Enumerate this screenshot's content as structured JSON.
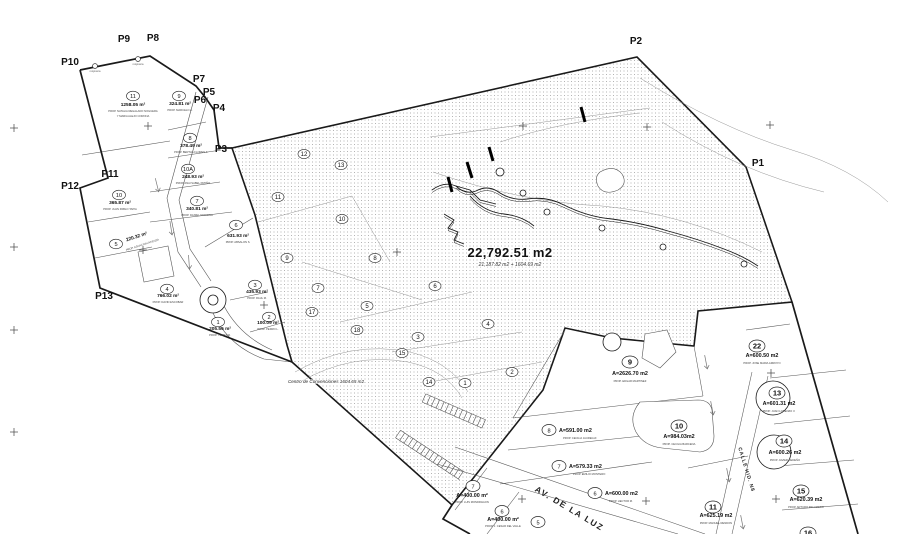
{
  "title_area": {
    "main": "22,792.51 m2",
    "sub": "21,187.82 m2 + 1604.69 m2"
  },
  "centro_label": "Centro de Convenciones 1604.65 m2",
  "boundary_points": [
    {
      "label": "P1",
      "x": 758,
      "y": 166
    },
    {
      "label": "P2",
      "x": 636,
      "y": 44
    },
    {
      "label": "P3",
      "x": 221,
      "y": 152
    },
    {
      "label": "P4",
      "x": 219,
      "y": 111
    },
    {
      "label": "P5",
      "x": 209,
      "y": 95
    },
    {
      "label": "P6",
      "x": 200,
      "y": 103
    },
    {
      "label": "P7",
      "x": 199,
      "y": 82
    },
    {
      "label": "P8",
      "x": 153,
      "y": 41
    },
    {
      "label": "P9",
      "x": 124,
      "y": 42
    },
    {
      "label": "P10",
      "x": 70,
      "y": 65
    },
    {
      "label": "P11",
      "x": 110,
      "y": 177
    },
    {
      "label": "P12",
      "x": 70,
      "y": 189
    },
    {
      "label": "P13",
      "x": 104,
      "y": 299
    }
  ],
  "streets": [
    {
      "label": "AV. DE LA LUZ",
      "x": 568,
      "y": 511,
      "angle": 31,
      "cls": "street"
    },
    {
      "label": "CALLE HID. N8",
      "x": 745,
      "y": 470,
      "angle": 73,
      "cls": "street2"
    }
  ],
  "monuments": [
    {
      "x": 95,
      "y": 66,
      "label": "mojonera"
    },
    {
      "x": 138,
      "y": 59,
      "label": "mojonera"
    }
  ],
  "left_parcels": [
    {
      "num": "11",
      "cx": 133,
      "cy": 96,
      "area": "1258.05 m²",
      "ax": 133,
      "ay": 106,
      "props": [
        "PROP. NATALIA REGALADO NOGUERA",
        "Y MARIA ALEJO CORONA"
      ],
      "px": 133,
      "py": 112
    },
    {
      "num": "9",
      "cx": 179,
      "cy": 96,
      "area": "324.81 m²",
      "ax": 180,
      "ay": 105,
      "props": [
        "PROP. MARCELO A."
      ],
      "px": 180,
      "py": 111
    },
    {
      "num": "8",
      "cx": 190,
      "cy": 138,
      "area": "378.49 m²",
      "ax": 191,
      "ay": 147,
      "props": [
        "PROP. BERTHA FLORES F."
      ],
      "px": 191,
      "py": 153
    },
    {
      "num": "10A",
      "cx": 188,
      "cy": 169,
      "area": "248.93 m²",
      "ax": 193,
      "ay": 178,
      "props": [
        "PROP. ANA ISABEL PATIÑO"
      ],
      "px": 193,
      "py": 184
    },
    {
      "num": "7",
      "cx": 197,
      "cy": 201,
      "area": "340.81 m²",
      "ax": 197,
      "ay": 210,
      "props": [
        "PROP. DANIEL NORIEGA"
      ],
      "px": 197,
      "py": 216
    },
    {
      "num": "6",
      "cx": 236,
      "cy": 225,
      "area": "631.93 m²",
      "ax": 238,
      "ay": 237,
      "props": [
        "PROP. ABSALON S."
      ],
      "px": 238,
      "py": 243
    },
    {
      "num": "10",
      "cx": 119,
      "cy": 195,
      "area": "365.87 m²",
      "ax": 120,
      "ay": 204,
      "props": [
        "PROP. JUAN PABLO TAPIA"
      ],
      "px": 120,
      "py": 210
    },
    {
      "num": "5",
      "cx": 116,
      "cy": 244,
      "area": "220.32 m²",
      "ax": 137,
      "ay": 238,
      "rot": -18,
      "props": [
        "PROP. ASUNCION ATIENZA"
      ],
      "px": 140,
      "py": 247
    },
    {
      "num": "4",
      "cx": 167,
      "cy": 289,
      "area": "766.02 m²",
      "ax": 168,
      "ay": 297,
      "props": [
        "PROP. DAVID ESCOBAR"
      ],
      "px": 168,
      "py": 303
    },
    {
      "num": "1",
      "cx": 218,
      "cy": 322,
      "area": "205.56 m²",
      "ax": 220,
      "ay": 330,
      "props": [
        "PROP. TOMAS R."
      ],
      "px": 220,
      "py": 336
    },
    {
      "num": "3",
      "cx": 255,
      "cy": 285,
      "area": "435.93 m²",
      "ax": 257,
      "ay": 293,
      "props": [
        "PROP. RAUL M."
      ],
      "px": 257,
      "py": 299
    },
    {
      "num": "2",
      "cx": 269,
      "cy": 317,
      "area": "100.09 m²",
      "ax": 268,
      "ay": 324,
      "props": [
        "PROP. PEDRO L."
      ],
      "px": 268,
      "py": 330
    }
  ],
  "subdivision_parcels": [
    {
      "num": "22",
      "cx": 757,
      "cy": 346,
      "area": "A=600.50 m2",
      "ax": 762,
      "ay": 357,
      "prop": "PROP. JOSE MARIA ARROYO",
      "px": 762,
      "py": 364,
      "big": true
    },
    {
      "num": "13",
      "cx": 777,
      "cy": 393,
      "area": "A=601.31 m2",
      "ax": 779,
      "ay": 405,
      "prop": "PROP. JUAN LORENZO V.",
      "px": 779,
      "py": 412,
      "big": true
    },
    {
      "num": "14",
      "cx": 784,
      "cy": 441,
      "area": "A=600.26 m2",
      "ax": 785,
      "ay": 454,
      "prop": "PROP. JAVIER CEDEÑO",
      "px": 785,
      "py": 461,
      "big": true
    },
    {
      "num": "15",
      "cx": 801,
      "cy": 491,
      "area": "A=620.39 m2",
      "ax": 806,
      "ay": 501,
      "prop": "PROP. ARTURO PALOMERO",
      "px": 806,
      "py": 508,
      "big": true
    },
    {
      "num": "16",
      "cx": 808,
      "cy": 533,
      "area": "",
      "ax": 0,
      "ay": 0,
      "prop": "",
      "px": 0,
      "py": 0,
      "big": true
    },
    {
      "num": "11",
      "cx": 713,
      "cy": 507,
      "area": "A=625.19 m2",
      "ax": 716,
      "ay": 517,
      "prop": "PROP. MANUEL RENDON",
      "px": 716,
      "py": 524,
      "big": true
    },
    {
      "num": "9",
      "cx": 630,
      "cy": 362,
      "area": "A=2626.70 m2",
      "ax": 630,
      "ay": 375,
      "prop": "PROP. EDGAR MARTINEZ",
      "px": 630,
      "py": 382,
      "big": true
    },
    {
      "num": "10",
      "cx": 679,
      "cy": 426,
      "area": "A=984.03m2",
      "ax": 679,
      "ay": 438,
      "prop": "PROP. CECILIA BARCENA",
      "px": 679,
      "py": 445,
      "big": true
    },
    {
      "num": "8",
      "cx": 549,
      "cy": 430,
      "area": "A=591.00 m2",
      "ax": 559,
      "ay": 432,
      "prop": "PROP. CECILIA JAUREGUI",
      "px": 563,
      "py": 439,
      "inline": true
    },
    {
      "num": "7",
      "cx": 559,
      "cy": 466,
      "area": "A=579.33 m2",
      "ax": 569,
      "ay": 468,
      "prop": "PROP. EMILIO MONTERO",
      "px": 573,
      "py": 475,
      "inline": true
    },
    {
      "num": "6",
      "cx": 595,
      "cy": 493,
      "area": "A=600.00 m2",
      "ax": 605,
      "ay": 495,
      "prop": "PROP. HECTOR M.",
      "px": 609,
      "py": 502,
      "inline": true
    },
    {
      "num": "7",
      "cx": 473,
      "cy": 486,
      "area": "A=400.00 m²",
      "ax": 472,
      "ay": 497,
      "prop": "PROP. LUIS MONDRAGON",
      "px": 472,
      "py": 503
    },
    {
      "num": "6",
      "cx": 502,
      "cy": 511,
      "area": "A=400.00 m²",
      "ax": 503,
      "ay": 521,
      "prop": "PROP. J. CESAR DEL VALLE",
      "px": 503,
      "py": 527
    },
    {
      "num": "5",
      "cx": 538,
      "cy": 522,
      "area": "",
      "ax": 0,
      "ay": 0,
      "prop": "",
      "px": 0,
      "py": 0
    }
  ],
  "hatch_numbers": [
    [
      "12",
      304,
      154
    ],
    [
      "13",
      341,
      165
    ],
    [
      "11",
      278,
      197
    ],
    [
      "10",
      342,
      219
    ],
    [
      "9",
      287,
      258
    ],
    [
      "8",
      375,
      258
    ],
    [
      "7",
      318,
      288
    ],
    [
      "6",
      435,
      286
    ],
    [
      "17",
      312,
      312
    ],
    [
      "5",
      367,
      306
    ],
    [
      "18",
      357,
      330
    ],
    [
      "3",
      418,
      337
    ],
    [
      "15",
      402,
      353
    ],
    [
      "14",
      429,
      382
    ],
    [
      "1",
      465,
      383
    ],
    [
      "2",
      512,
      372
    ],
    [
      "4",
      488,
      324
    ]
  ],
  "colors": {
    "line": "#1a1a1a",
    "thin": "#555555",
    "faint": "#8a8a8a",
    "stipple": "#9a9a9a"
  },
  "geometry": {
    "hatch_polygon": "232,148 637,57 746,167 792,302 698,311 694,346 612,338 565,328 543,390 452,505 292,362 287,345 255,215",
    "bold_polylines": [
      "80,70 150,56 196,86 205,97 214,110 219,148 232,148",
      "80,70 108,178 80,188 100,288 292,362",
      "452,505 443,519 470,534",
      "792,302 858,534"
    ],
    "thin_segments": [
      [
        82,
        155,
        170,
        141
      ],
      [
        168,
        130,
        206,
        122
      ],
      [
        168,
        158,
        221,
        150
      ],
      [
        150,
        192,
        220,
        182
      ],
      [
        88,
        222,
        150,
        212
      ],
      [
        150,
        222,
        232,
        212
      ],
      [
        95,
        258,
        152,
        247
      ],
      [
        205,
        247,
        253,
        218
      ],
      [
        230,
        300,
        268,
        292
      ],
      [
        250,
        332,
        285,
        322
      ],
      [
        513,
        418,
        703,
        396
      ],
      [
        508,
        450,
        642,
        436
      ],
      [
        500,
        484,
        652,
        462
      ],
      [
        688,
        468,
        748,
        456
      ],
      [
        752,
        372,
        716,
        534
      ],
      [
        768,
        376,
        732,
        534
      ],
      [
        770,
        378,
        846,
        370
      ],
      [
        774,
        424,
        850,
        416
      ],
      [
        778,
        466,
        854,
        460
      ],
      [
        782,
        510,
        858,
        504
      ],
      [
        455,
        447,
        705,
        534
      ],
      [
        437,
        464,
        678,
        534
      ],
      [
        487,
        468,
        455,
        510
      ],
      [
        519,
        492,
        487,
        534
      ],
      [
        565,
        330,
        513,
        418
      ],
      [
        694,
        346,
        703,
        396
      ],
      [
        746,
        330,
        790,
        324
      ]
    ],
    "thin_paths": [
      "M196,92 L167,198 L178,252 L201,287",
      "M208,97 L179,200 L190,249 L211,281",
      "M213,313 Q228,346 264,359 L292,362",
      "M224,306 Q240,336 272,350",
      "M640,402 Q628,416 636,432 Q644,446 662,448 L700,452 Q714,450 714,436 L712,410 Q710,400 698,400 Z",
      "M600,172 Q614,164 622,174 Q628,184 618,190 Q604,196 598,186 Q594,177 600,172 Z",
      "M645,334 L667,330 L676,352 L660,368 L642,358 Z"
    ],
    "faint_paths": [
      "M430,137 L650,108",
      "M640,78 Q720,128 792,150 Q852,168 888,202",
      "M662,122 Q740,172 824,192",
      "M500,142 Q560,122 640,113",
      "M433,172 Q520,202 602,206 Q686,214 762,252",
      "M258,222 L352,196",
      "M352,196 L390,262",
      "M302,262 L422,300",
      "M340,322 L472,292",
      "M392,352 L522,332",
      "M430,382 L542,362",
      "M295,372 Q350,340 410,352 Q450,362 468,392",
      "M300,382 Q352,352 408,362 Q446,370 462,398"
    ],
    "stream_paths": [
      "M432,190 q12,-9 24,-4 q9,9 20,5 q11,-6 21,0 q14,10 30,8 q20,-3 37,6 q24,12 48,14 q30,4 56,12 q30,8 56,18 q19,7 34,17",
      "M470,196 q14,16 34,18 q18,2 30,12",
      "M444,214 l10,6 -6,8 10,4 -4,8 10,4",
      "M456,186 l14,4 10,10 16,4"
    ],
    "stream_circles": [
      [
        500,
        172,
        4
      ],
      [
        523,
        193,
        3
      ],
      [
        547,
        212,
        3
      ],
      [
        602,
        228,
        3
      ],
      [
        663,
        247,
        3
      ],
      [
        744,
        264,
        3
      ]
    ],
    "bold_ticks": [
      [
        448,
        177,
        452,
        192
      ],
      [
        467,
        162,
        472,
        178
      ],
      [
        489,
        147,
        493,
        161
      ],
      [
        581,
        107,
        585,
        122
      ]
    ],
    "big_circles": [
      [
        773,
        398,
        17
      ],
      [
        774,
        452,
        17
      ],
      [
        612,
        342,
        9
      ],
      [
        213,
        300,
        13
      ],
      [
        213,
        300,
        5
      ]
    ],
    "building_square": "138,252 168,246 174,276 144,282",
    "ladders": [
      [
        424,
        398,
        484,
        424
      ],
      [
        398,
        434,
        462,
        476
      ]
    ],
    "crosses": [
      [
        14,
        128
      ],
      [
        14,
        247
      ],
      [
        14,
        330
      ],
      [
        14,
        432
      ],
      [
        148,
        126
      ],
      [
        143,
        250
      ],
      [
        523,
        126
      ],
      [
        647,
        127
      ],
      [
        770,
        125
      ],
      [
        397,
        252
      ],
      [
        264,
        305
      ],
      [
        522,
        499
      ],
      [
        646,
        501
      ],
      [
        771,
        373
      ],
      [
        776,
        499
      ],
      [
        627,
        362
      ]
    ],
    "arrows": [
      [
        157,
        185,
        -14
      ],
      [
        171,
        228,
        -9
      ],
      [
        189,
        262,
        -4
      ],
      [
        706,
        362,
        -11
      ],
      [
        712,
        408,
        -11
      ],
      [
        728,
        475,
        -11
      ],
      [
        742,
        522,
        -11
      ]
    ]
  }
}
